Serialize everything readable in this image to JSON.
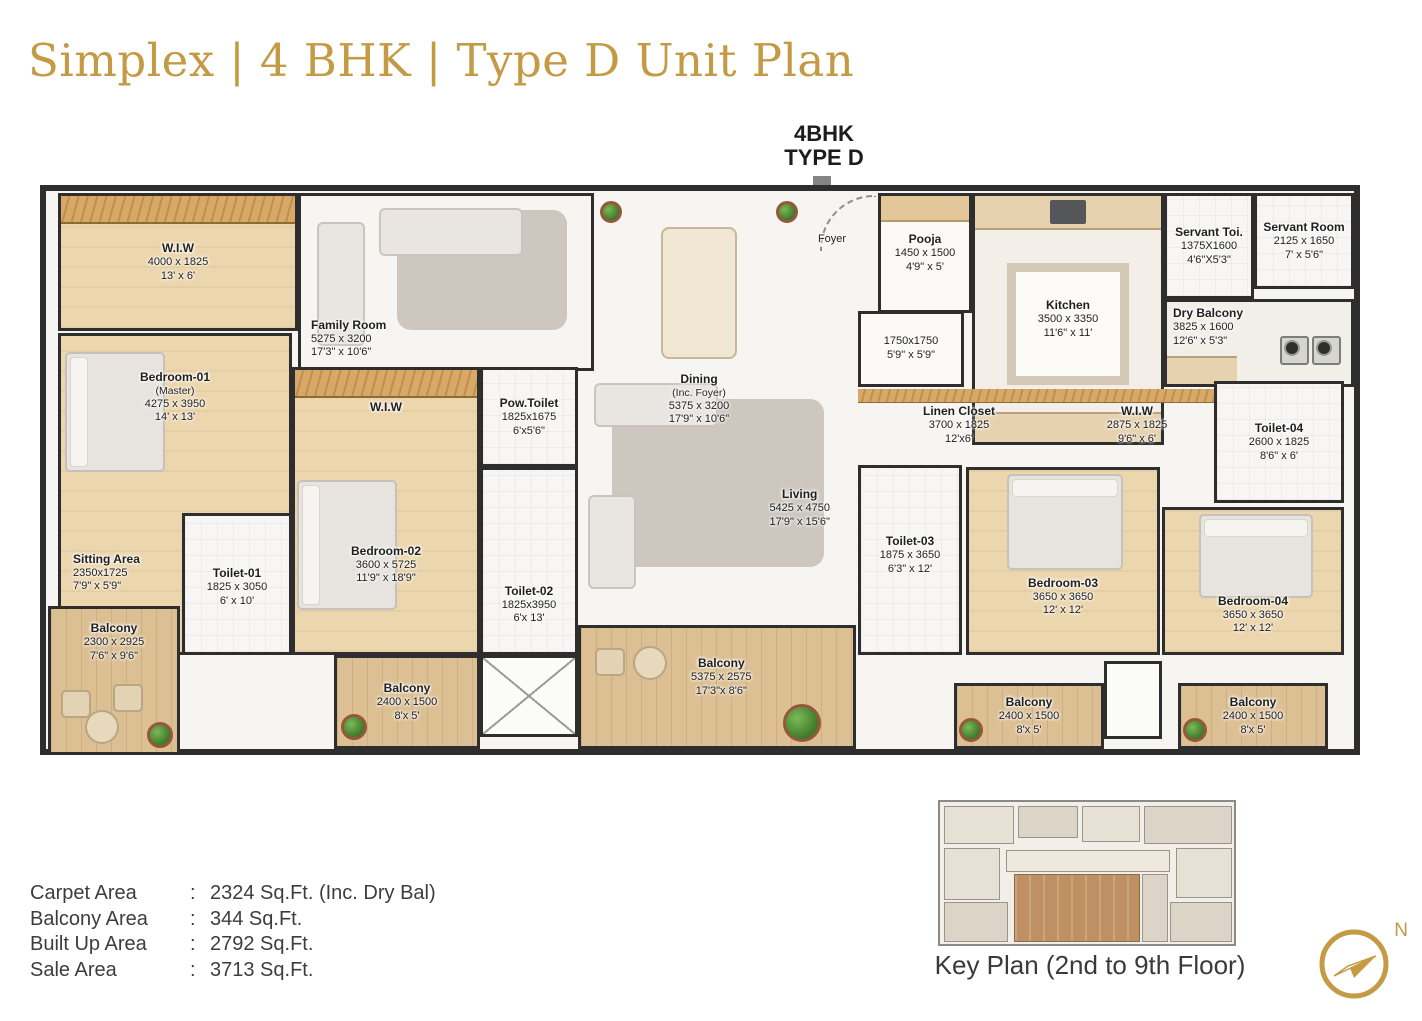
{
  "title": "Simplex | 4 BHK | Type D Unit Plan",
  "callout": {
    "line1": "4BHK",
    "line2": "TYPE D"
  },
  "rooms": {
    "wiw1": {
      "name": "W.I.W",
      "mm": "4000 x 1825",
      "ft": "13' x 6'"
    },
    "family_room": {
      "name": "Family Room",
      "mm": "5275 x 3200",
      "ft": "17'3\" x 10'6\""
    },
    "dining": {
      "name": "Dining",
      "sub": "(Inc. Foyer)",
      "mm": "5375 x 3200",
      "ft": "17'9\" x 10'6\""
    },
    "foyer": {
      "name": "Foyer"
    },
    "pooja": {
      "name": "Pooja",
      "mm": "1450 x 1500",
      "ft": "4'9\" x 5'"
    },
    "kitchen": {
      "name": "Kitchen",
      "mm": "3500 x 3350",
      "ft": "11'6\" x 11'"
    },
    "servant_toilet": {
      "name": "Servant Toi.",
      "mm": "1375X1600",
      "ft": "4'6\"X5'3\""
    },
    "servant_room": {
      "name": "Servant Room",
      "mm": "2125 x 1650",
      "ft": "7' x 5'6\""
    },
    "dry_balcony": {
      "name": "Dry Balcony",
      "mm": "3825 x 1600",
      "ft": "12'6\" x 5'3\""
    },
    "store_1750": {
      "mm": "1750x1750",
      "ft": "5'9\" x 5'9\""
    },
    "bedroom_01": {
      "name": "Bedroom-01",
      "sub": "(Master)",
      "mm": "4275 x 3950",
      "ft": "14' x 13'"
    },
    "sitting_area": {
      "name": "Sitting Area",
      "mm": "2350x1725",
      "ft": "7'9\" x 5'9\""
    },
    "wiw2": {
      "name": "W.I.W"
    },
    "bedroom_02": {
      "name": "Bedroom-02",
      "mm": "3600 x 5725",
      "ft": "11'9\" x 18'9\""
    },
    "pow_toilet": {
      "name": "Pow.Toilet",
      "mm": "1825x1675",
      "ft": "6'x5'6\""
    },
    "toilet_01": {
      "name": "Toilet-01",
      "mm": "1825 x 3050",
      "ft": "6' x 10'"
    },
    "toilet_02": {
      "name": "Toilet-02",
      "mm": "1825x3950",
      "ft": "6'x 13'"
    },
    "living": {
      "name": "Living",
      "mm": "5425 x 4750",
      "ft": "17'9\" x 15'6\""
    },
    "linen_closet": {
      "name": "Linen Closet",
      "mm": "3700 x 1825",
      "ft": "12'x6'"
    },
    "wiw3": {
      "name": "W.I.W",
      "mm": "2875 x 1825",
      "ft": "9'6\" x 6'"
    },
    "toilet_03": {
      "name": "Toilet-03",
      "mm": "1875 x 3650",
      "ft": "6'3\" x 12'"
    },
    "toilet_04": {
      "name": "Toilet-04",
      "mm": "2600 x 1825",
      "ft": "8'6\" x 6'"
    },
    "bedroom_03": {
      "name": "Bedroom-03",
      "mm": "3650 x 3650",
      "ft": "12' x 12'"
    },
    "bedroom_04": {
      "name": "Bedroom-04",
      "mm": "3650 x 3650",
      "ft": "12' x 12'"
    },
    "balcony_master": {
      "name": "Balcony",
      "mm": "2300 x 2925",
      "ft": "7'6\" x 9'6\""
    },
    "balcony_b2": {
      "name": "Balcony",
      "mm": "2400 x 1500",
      "ft": "8'x 5'"
    },
    "balcony_center": {
      "name": "Balcony",
      "mm": "5375 x 2575",
      "ft": "17'3\"x 8'6\""
    },
    "balcony_b3": {
      "name": "Balcony",
      "mm": "2400 x 1500",
      "ft": "8'x 5'"
    },
    "balcony_b4": {
      "name": "Balcony",
      "mm": "2400 x 1500",
      "ft": "8'x 5'"
    }
  },
  "areas": {
    "sep": ":",
    "rows": [
      {
        "label": "Carpet Area",
        "value": "2324 Sq.Ft. (Inc. Dry Bal)"
      },
      {
        "label": "Balcony Area",
        "value": "344 Sq.Ft."
      },
      {
        "label": "Built Up Area",
        "value": "2792 Sq.Ft."
      },
      {
        "label": "Sale Area",
        "value": "3713 Sq.Ft."
      }
    ]
  },
  "key_plan": {
    "caption": "Key Plan (2nd to 9th Floor)"
  },
  "compass": {
    "north_label": "N"
  },
  "colors": {
    "gold": "#c49a45",
    "wall": "#2e2e2f",
    "wood": "#ecd6ad",
    "highlight_brown": "#bf9061"
  }
}
